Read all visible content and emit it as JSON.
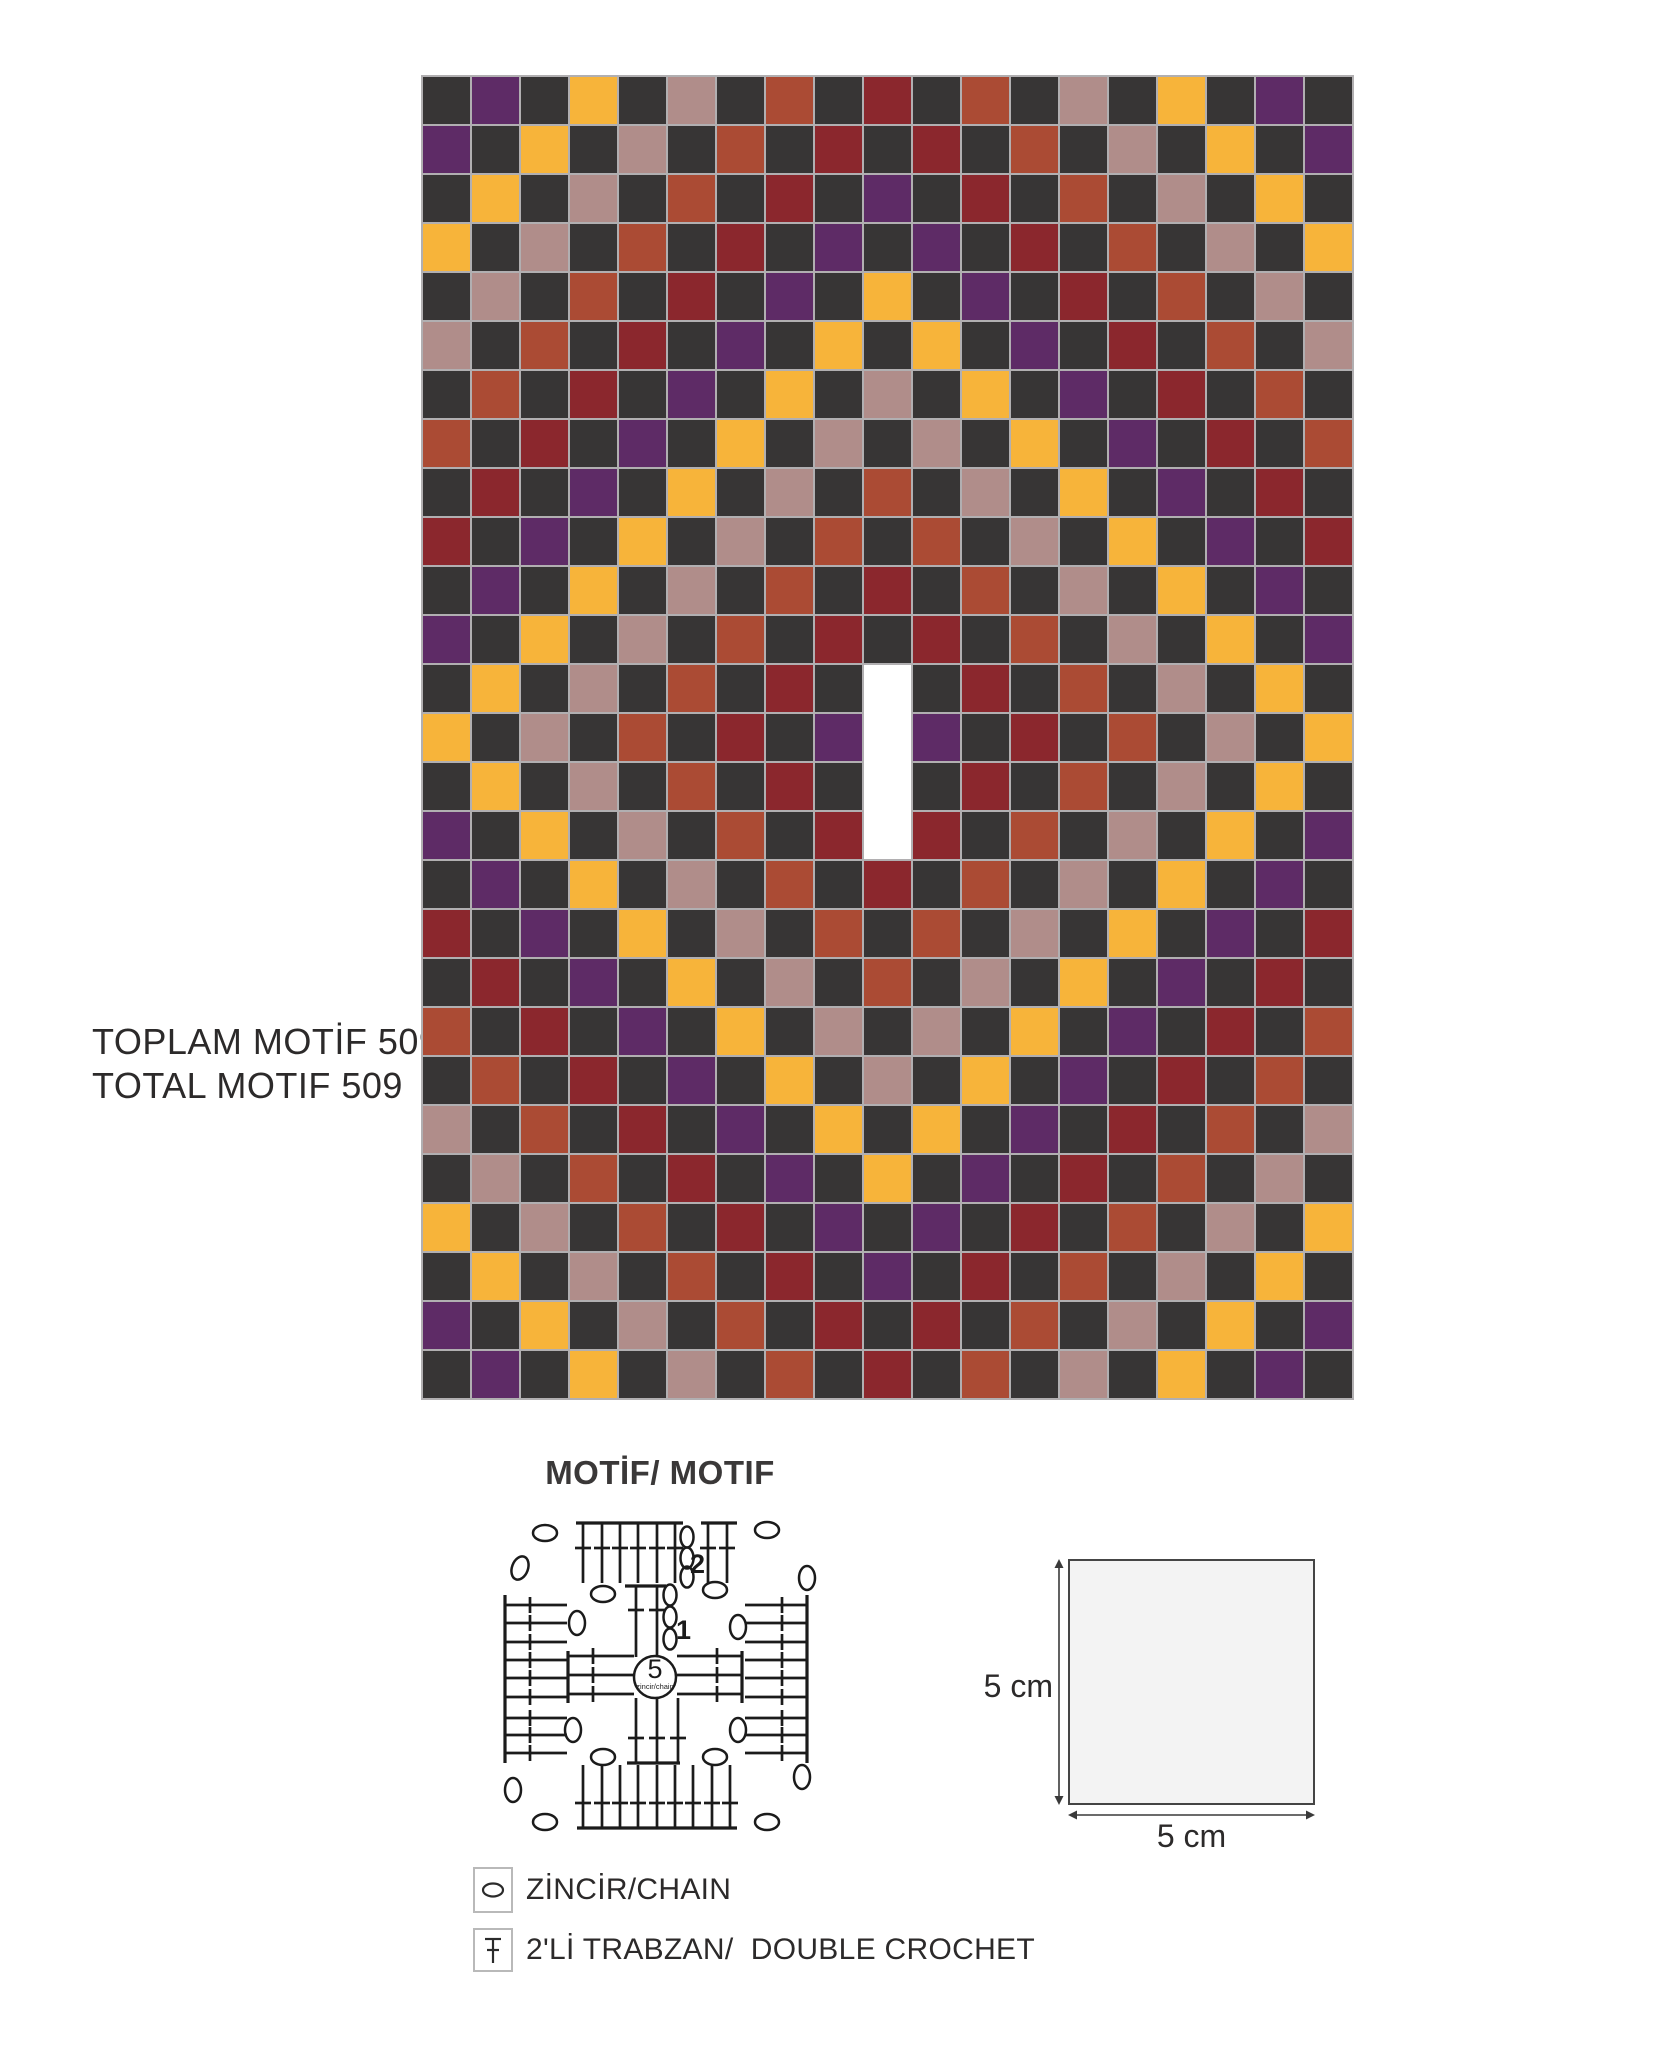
{
  "labels": {
    "total_line1": "TOPLAM MOTİF 509",
    "total_line2": "TOTAL MOTIF 509",
    "motif_heading": "MOTİF/ MOTIF",
    "total_motif_count": 509
  },
  "chart_data": {
    "type": "heatmap",
    "title": "Crochet motif color placement chart",
    "columns": 19,
    "rows": 27,
    "total_motifs": 509,
    "grid_line_color": "#b1afb1",
    "palette": {
      "K": {
        "name": "dark-gray",
        "hex": "#373535"
      },
      "P": {
        "name": "purple",
        "hex": "#5e2b66"
      },
      "Y": {
        "name": "yellow",
        "hex": "#f7b43a"
      },
      "M": {
        "name": "rose-mauve",
        "hex": "#b08d8a"
      },
      "R": {
        "name": "rust",
        "hex": "#ab4b34"
      },
      "D": {
        "name": "maroon",
        "hex": "#8b272d"
      },
      "W": {
        "name": "empty-slit",
        "hex": "#ffffff"
      }
    },
    "grid_rows": [
      "KPKYKMKRKDKRKMKYKPK",
      "PKYKMKRKDKDKRKMKYKP",
      "KYKMKRKDKPKDKRKMKYK",
      "YKMKRKDKPKPKDKRKMKY",
      "KMKRKDKPKYKPKDKRKMK",
      "MKRKDKPKYKYKPKDKRKM",
      "KRKDKPKYKMKYKPKDKRK",
      "RKDKPKYKMKMKYKPKDKR",
      "KDKPKYKMKRKMKYKPKDK",
      "DKPKYKMKRKRKMKYKPKD",
      "KPKYKMKRKDKRKMKYKPK",
      "PKYKMKRKDKDKRKMKYKP",
      "KYKMKRKDKWKDKRKMKYK",
      "YKMKRKDKPWPKDKRKMKY",
      "KYKMKRKDKWKDKRKMKYK",
      "PKYKMKRKDWDKRKMKYKP",
      "KPKYKMKRKDKRKMKYKPK",
      "DKPKYKMKRKRKMKYKPKD",
      "KDKPKYKMKRKMKYKPKDK",
      "RKDKPKYKMKMKYKPKDKR",
      "KRKDKPKYKMKYKPKDKRK",
      "MKRKDKPKYKYKPKDKRKM",
      "KMKRKDKPKYKPKDKRKMK",
      "YKMKRKDKPKPKDKRKMKY",
      "KYKMKRKDKPKDKRKMKYK",
      "PKYKMKRKDKDKRKMKYKP",
      "KPKYKMKRKDKRKMKYKPK"
    ]
  },
  "motif_diagram": {
    "center_ring_count": "5",
    "center_ring_label": "zincir/chain",
    "round_1_number": "1",
    "round_2_number": "2",
    "accent_color": "#e8127f"
  },
  "dimensions": {
    "width_label": "5 cm",
    "height_label": "5 cm"
  },
  "legend": {
    "chain_label": "ZİNCİR/CHAIN",
    "dc_label": "2'Lİ TRABZAN/  DOUBLE CROCHET"
  }
}
